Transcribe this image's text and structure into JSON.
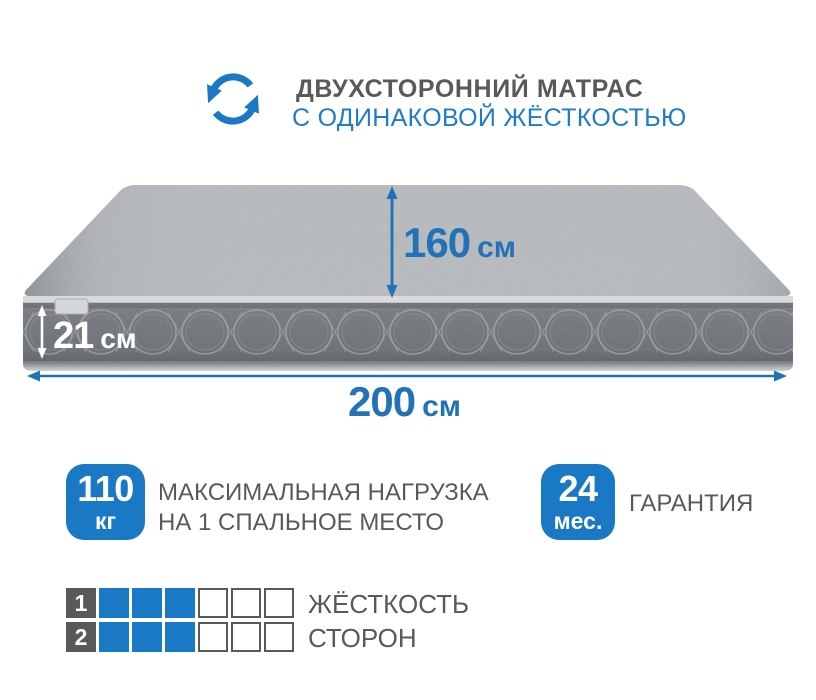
{
  "header": {
    "title": "ДВУХСТОРОННИЙ МАТРАС",
    "subtitle": "С ОДИНАКОВОЙ ЖЁСТКОСТЬЮ"
  },
  "dimensions": {
    "width": {
      "value": "160",
      "unit": "см"
    },
    "height": {
      "value": "21",
      "unit": "см"
    },
    "length": {
      "value": "200",
      "unit": "см"
    }
  },
  "badges": [
    {
      "value": "110",
      "unit": "кг",
      "label_line1": "МАКСИМАЛЬНАЯ НАГРУЗКА",
      "label_line2": "НА 1 СПАЛЬНОЕ МЕСТО"
    },
    {
      "value": "24",
      "unit": "мес.",
      "label_line1": "ГАРАНТИЯ",
      "label_line2": ""
    }
  ],
  "firmness": {
    "rows": [
      {
        "index": "1",
        "filled": 3,
        "total": 6
      },
      {
        "index": "2",
        "filled": 3,
        "total": 6
      }
    ],
    "label_line1": "ЖЁСТКОСТЬ",
    "label_line2": "СТОРОН"
  },
  "icons": {
    "rotate": "rotate-arrows-icon"
  },
  "colors": {
    "accent_blue": "#1a79c4",
    "dimension_blue": "#2272b8",
    "subtitle_blue": "#1e7cc8",
    "text_gray": "#58595b",
    "mattress_top": "#bcbfc2",
    "mattress_side": "#73767a"
  }
}
